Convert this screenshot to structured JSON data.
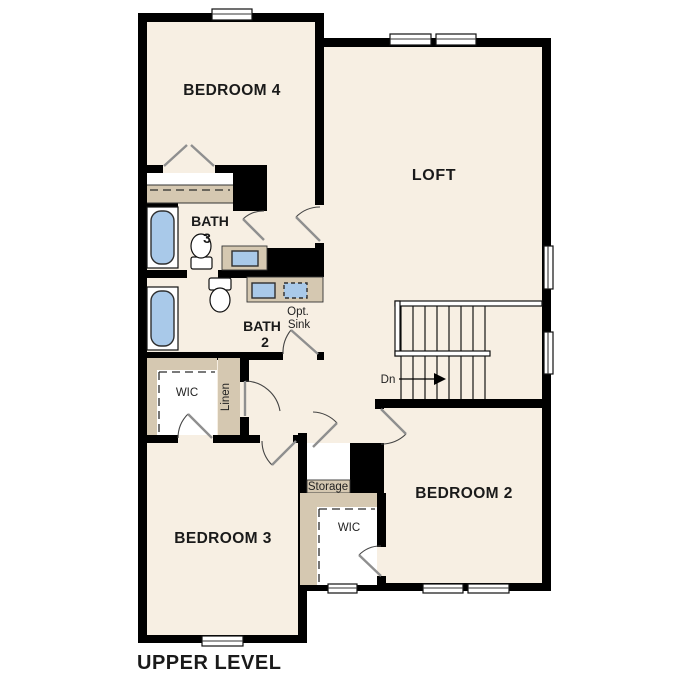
{
  "plan_title": "UPPER LEVEL",
  "labels": {
    "bedroom4": "BEDROOM 4",
    "loft": "LOFT",
    "bath3_line1": "BATH",
    "bath3_line2": "3",
    "bath2_line1": "BATH",
    "bath2_line2": "2",
    "opt_sink_line1": "Opt.",
    "opt_sink_line2": "Sink",
    "wic_left": "WIC",
    "linen": "Linen",
    "storage": "Storage",
    "wic_right": "WIC",
    "bedroom3": "BEDROOM 3",
    "bedroom2": "BEDROOM 2",
    "stair_direction": "Dn"
  },
  "colors": {
    "floor": "#f7efe3",
    "closet": "#d5c8b1",
    "fixture": "#a9c9e9",
    "wall": "#000000",
    "door_leaf": "#8f8f8f",
    "door_arc": "#444444",
    "text": "#1a1a1a"
  }
}
